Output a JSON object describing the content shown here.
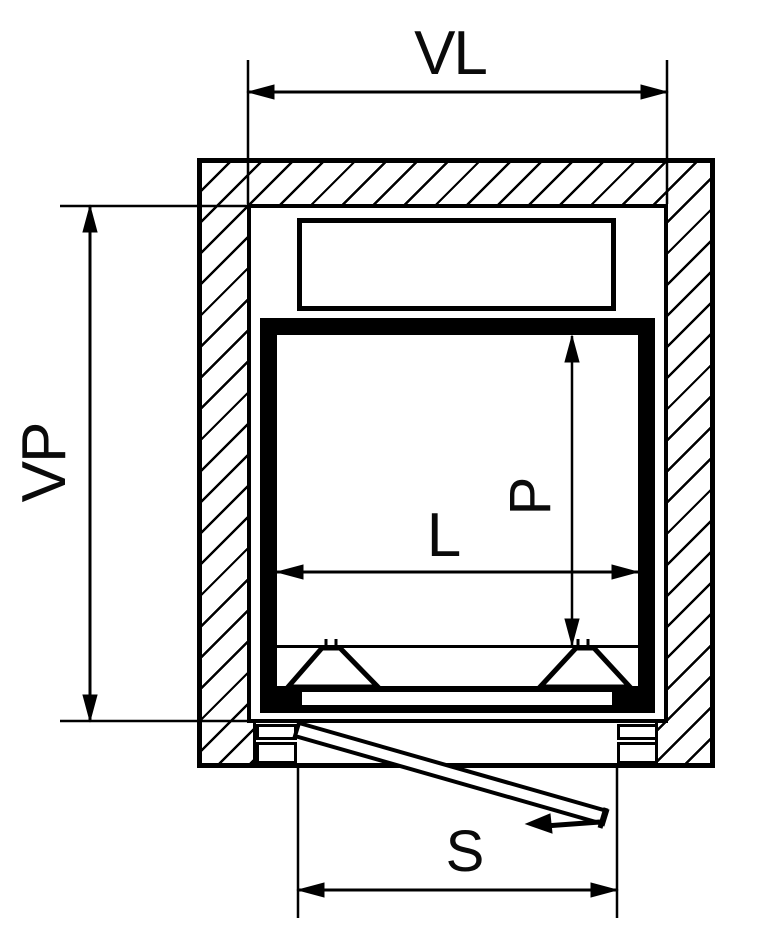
{
  "drawing": {
    "type": "elevator-shaft-plan-view",
    "dimensions": {
      "shaft_width": {
        "label": "VL"
      },
      "shaft_depth": {
        "label": "VP"
      },
      "car_width": {
        "label": "L"
      },
      "car_depth": {
        "label": "P"
      },
      "door_width": {
        "label": "S"
      }
    },
    "colors": {
      "line": "#000000",
      "background": "#ffffff"
    }
  }
}
